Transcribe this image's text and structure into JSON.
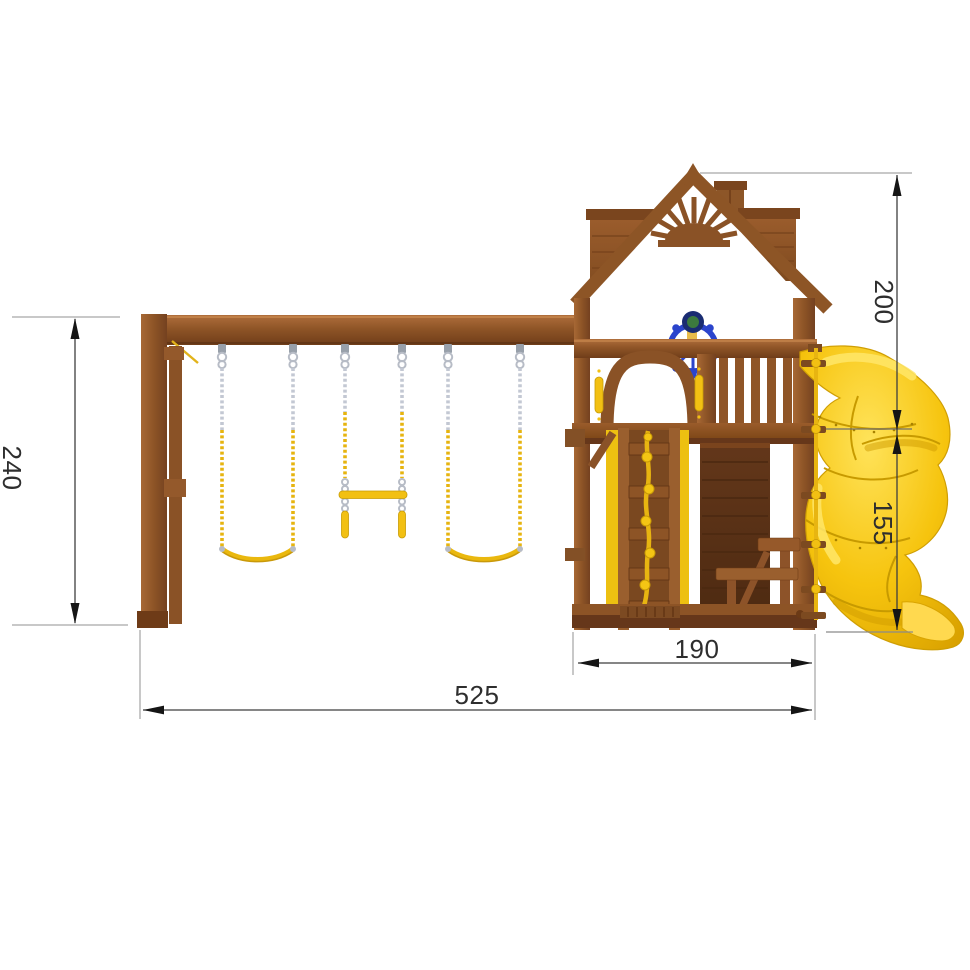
{
  "drawing": {
    "description": "Side-view dimension drawing of a wooden playground set with swings, playhouse tower and spiral slide",
    "dimensions": {
      "total_height": "240",
      "tower_height": "200",
      "slide_platform_height": "155",
      "tower_base_width": "190",
      "overall_length": "525"
    },
    "colors": {
      "wood_light": "#a66834",
      "wood_mid": "#8a5226",
      "wood_dark": "#5d3317",
      "slide_yellow": "#f6c40e",
      "chain_silver": "#c3c8d3",
      "chain_yellow": "#e6b40f",
      "wheel_blue": "#2b44cc",
      "dimension_line": "#3f3f3f",
      "extension_line": "#b6b6b6",
      "background": "#ffffff"
    },
    "parts": [
      "swing-beam",
      "a-frame-post",
      "belt-swing-left",
      "trapeze-bar",
      "belt-swing-right",
      "playhouse-tower",
      "gable-roof-with-sunburst",
      "chimney",
      "steering-wheel",
      "balcony-railing",
      "arched-window",
      "climbing-wall-with-rope",
      "picnic-bench",
      "spiral-slide",
      "exterior-climbing-rope"
    ]
  }
}
